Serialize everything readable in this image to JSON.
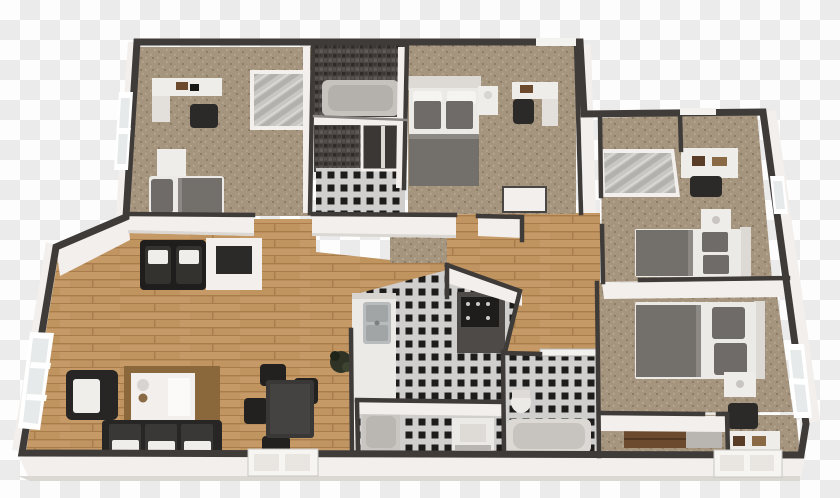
{
  "scene": {
    "description": "3D rendered top-down floor plan of a four-bedroom apartment on a transparent checkerboard background",
    "view": "bird's-eye 3D dollhouse render, slight perspective tilt"
  },
  "background": {
    "checker_light": "#fdfdfd",
    "checker_dark": "#ebebeb",
    "square_px": 20
  },
  "palette": {
    "wall_cap": "#3f3b39",
    "wall_face": "#f2efec",
    "wall_face_shade": "#dbd7d2",
    "wood_base": "#c59a67",
    "wood_line": "#a87c4b",
    "wood_alt": "#b88b55",
    "carpet_base": "#a5947e",
    "carpet_dark": "#8d7c66",
    "carpet_light": "#bcab93",
    "tile_bg": "#d0cfcd",
    "tile_black": "#1d1c1b",
    "mosaic_base": "#4a4543",
    "mosaic_dark": "#2e2b29",
    "mosaic_light": "#5f5a57",
    "rug": "#8a683c",
    "sofa_dark": "#272625",
    "table_dark": "#3a3836",
    "blanket_gray": "#73706c",
    "pillow_gray": "#6f6b68",
    "linen_white": "#eceae6",
    "counter_white": "#eceae6",
    "counter_dark": "#4e4a47",
    "stove_black": "#1f1d1c",
    "mirror_panel": "#c9c7c4",
    "window_pane": "#e7eaea",
    "shelf_brown": "#6b4a2e",
    "plant_green": "#2e3326",
    "steel": "#b9bcbd",
    "tub_gray": "#b4b1ad"
  },
  "rooms": [
    {
      "id": 0,
      "name": "bedroom upper left",
      "floor": "carpet"
    },
    {
      "id": 1,
      "name": "main bathroom with tub and shower",
      "floor": "checker tile"
    },
    {
      "id": 2,
      "name": "master bedroom",
      "floor": "carpet"
    },
    {
      "id": 3,
      "name": "bedroom right wing north",
      "floor": "carpet"
    },
    {
      "id": 4,
      "name": "bedroom right wing south",
      "floor": "carpet"
    },
    {
      "id": 5,
      "name": "living room",
      "floor": "wood"
    },
    {
      "id": 6,
      "name": "dining area",
      "floor": "wood"
    },
    {
      "id": 7,
      "name": "kitchen",
      "floor": "checker tile"
    },
    {
      "id": 8,
      "name": "bathroom center with shower and washer",
      "floor": "checker tile"
    },
    {
      "id": 9,
      "name": "laundry bathroom with tub and toilet",
      "floor": "checker tile"
    },
    {
      "id": 10,
      "name": "walk-in closet",
      "floor": "carpet"
    },
    {
      "id": 11,
      "name": "hallway",
      "floor": "wood"
    },
    {
      "id": 12,
      "name": "corridor upper left",
      "floor": "carpet"
    }
  ],
  "furniture": {
    "bedroom_upper_left": [
      "desk with books",
      "desk chair",
      "sliding-door closet",
      "nightstand",
      "single bed with gray pillow and blanket"
    ],
    "main_bathroom": [
      "bathtub",
      "dark mosaic tiled walls",
      "glass shower cabin"
    ],
    "master_bedroom": [
      "double bed with two gray pillows",
      "nightstand",
      "desk",
      "desk chair"
    ],
    "bedroom_right_north": [
      "mirrored sliding closet",
      "desk with books",
      "desk chair",
      "double bed",
      "nightstand with lamp"
    ],
    "bedroom_right_south": [
      "double bed",
      "nightstand with lamp",
      "chair",
      "desk with books"
    ],
    "living_room": [
      "two dark armchairs",
      "media cabinet",
      "armchair with white cushion",
      "brown rug",
      "white coffee table with decor",
      "three-seat dark sofa with white cushions",
      "potted plant"
    ],
    "dining_area": [
      "dark dining table",
      "four dark chairs"
    ],
    "kitchen": [
      "white counter with double sink",
      "dark counter with stove"
    ],
    "bathroom_center": [
      "shower base",
      "washing machine"
    ],
    "laundry_bathroom": [
      "toilet",
      "bathtub",
      "glass partition"
    ],
    "walk_in_closet": [
      "brown shelving unit"
    ],
    "hallway": [
      "built-in closet"
    ]
  },
  "openings": {
    "entry_door": "white front door, bottom wall center-left",
    "porch_door": "white door, bottom wall right",
    "windows": [
      "left wall living room double window",
      "upper-left wing west window",
      "right wall small window",
      "right wall large window",
      "master bedroom top window"
    ]
  }
}
